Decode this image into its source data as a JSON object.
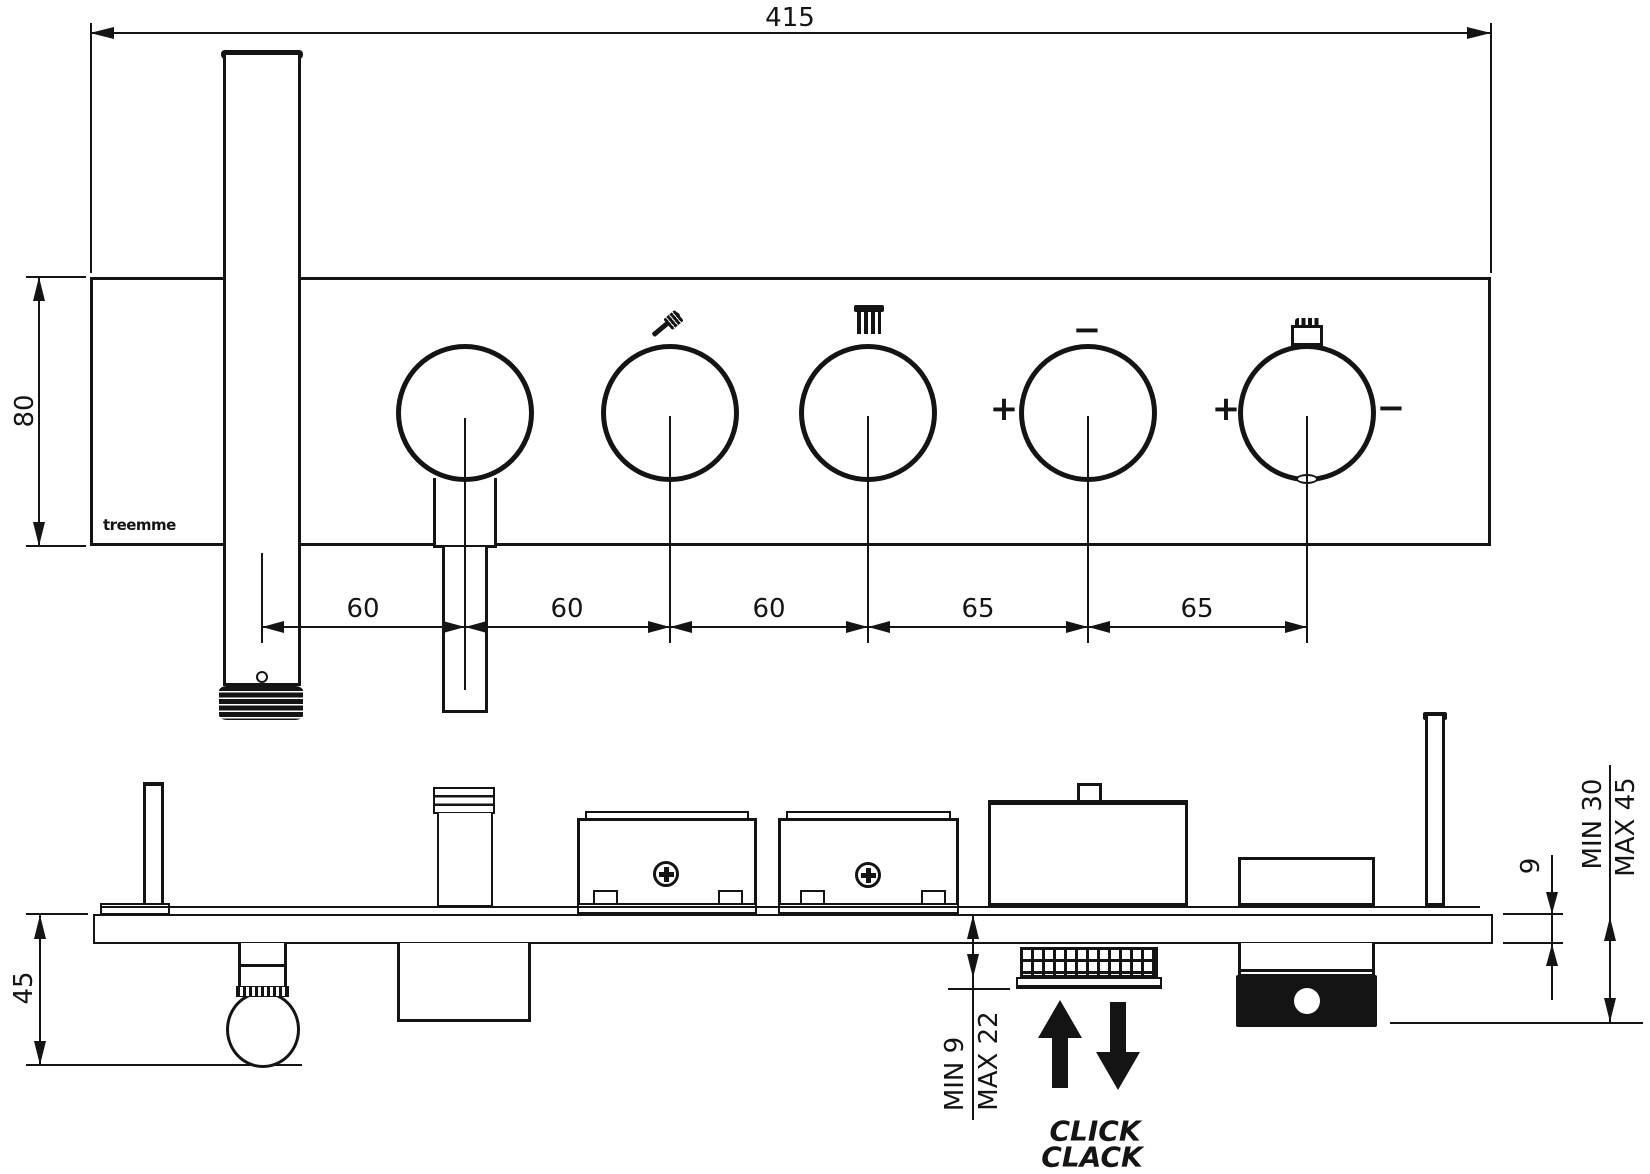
{
  "brand": "treemme",
  "top_view": {
    "dim_width": "415",
    "dim_height": "80",
    "dim_spacings": [
      "60",
      "60",
      "60",
      "65",
      "65"
    ],
    "knob4": {
      "left": "+",
      "top": "−"
    },
    "knob5": {
      "left": "+",
      "right": "−"
    }
  },
  "side_view": {
    "dim_depth": "45",
    "dim_plate_thickness": "9",
    "dim_projection_min": "MIN 30",
    "dim_projection_max": "MAX 45",
    "dim_travel_min": "MIN 9",
    "dim_travel_max": "MAX 22",
    "label_click": "CLICK",
    "label_clack": "CLACK"
  }
}
